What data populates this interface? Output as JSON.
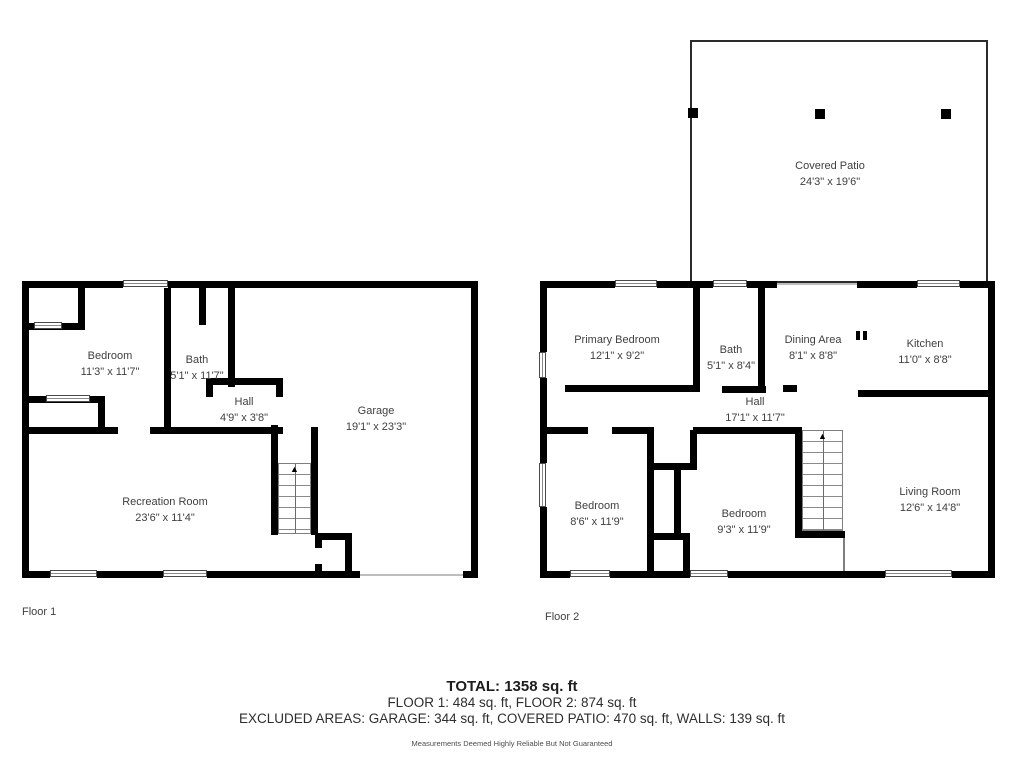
{
  "floor1": {
    "label": "Floor 1",
    "rooms": {
      "bedroom": {
        "name": "Bedroom",
        "dims": "11'3\" x 11'7\""
      },
      "bath": {
        "name": "Bath",
        "dims": "5'1\" x 11'7\""
      },
      "hall": {
        "name": "Hall",
        "dims": "4'9\" x 3'8\""
      },
      "garage": {
        "name": "Garage",
        "dims": "19'1\" x 23'3\""
      },
      "recreation": {
        "name": "Recreation Room",
        "dims": "23'6\" x 11'4\""
      }
    }
  },
  "floor2": {
    "label": "Floor 2",
    "rooms": {
      "covered_patio": {
        "name": "Covered Patio",
        "dims": "24'3\" x 19'6\""
      },
      "primary_bedroom": {
        "name": "Primary Bedroom",
        "dims": "12'1\" x 9'2\""
      },
      "bath": {
        "name": "Bath",
        "dims": "5'1\" x 8'4\""
      },
      "dining_area": {
        "name": "Dining Area",
        "dims": "8'1\" x 8'8\""
      },
      "kitchen": {
        "name": "Kitchen",
        "dims": "11'0\" x 8'8\""
      },
      "hall": {
        "name": "Hall",
        "dims": "17'1\" x 11'7\""
      },
      "bedroom_left": {
        "name": "Bedroom",
        "dims": "8'6\" x 11'9\""
      },
      "bedroom_right": {
        "name": "Bedroom",
        "dims": "9'3\" x 11'9\""
      },
      "living_room": {
        "name": "Living Room",
        "dims": "12'6\" x 14'8\""
      }
    }
  },
  "summary": {
    "total": "TOTAL: 1358 sq. ft",
    "floors_line": "FLOOR 1: 484 sq. ft, FLOOR 2: 874 sq. ft",
    "excluded_line": "EXCLUDED AREAS: GARAGE: 344 sq. ft, COVERED PATIO: 470 sq. ft, WALLS: 139 sq. ft",
    "disclaimer": "Measurements Deemed Highly Reliable But Not Guaranteed"
  },
  "icons": {
    "stairs_up_arrow": "▲"
  },
  "colors": {
    "wall": "#000000",
    "text": "#3f3f3f",
    "window_line": "#8a8a8a"
  }
}
